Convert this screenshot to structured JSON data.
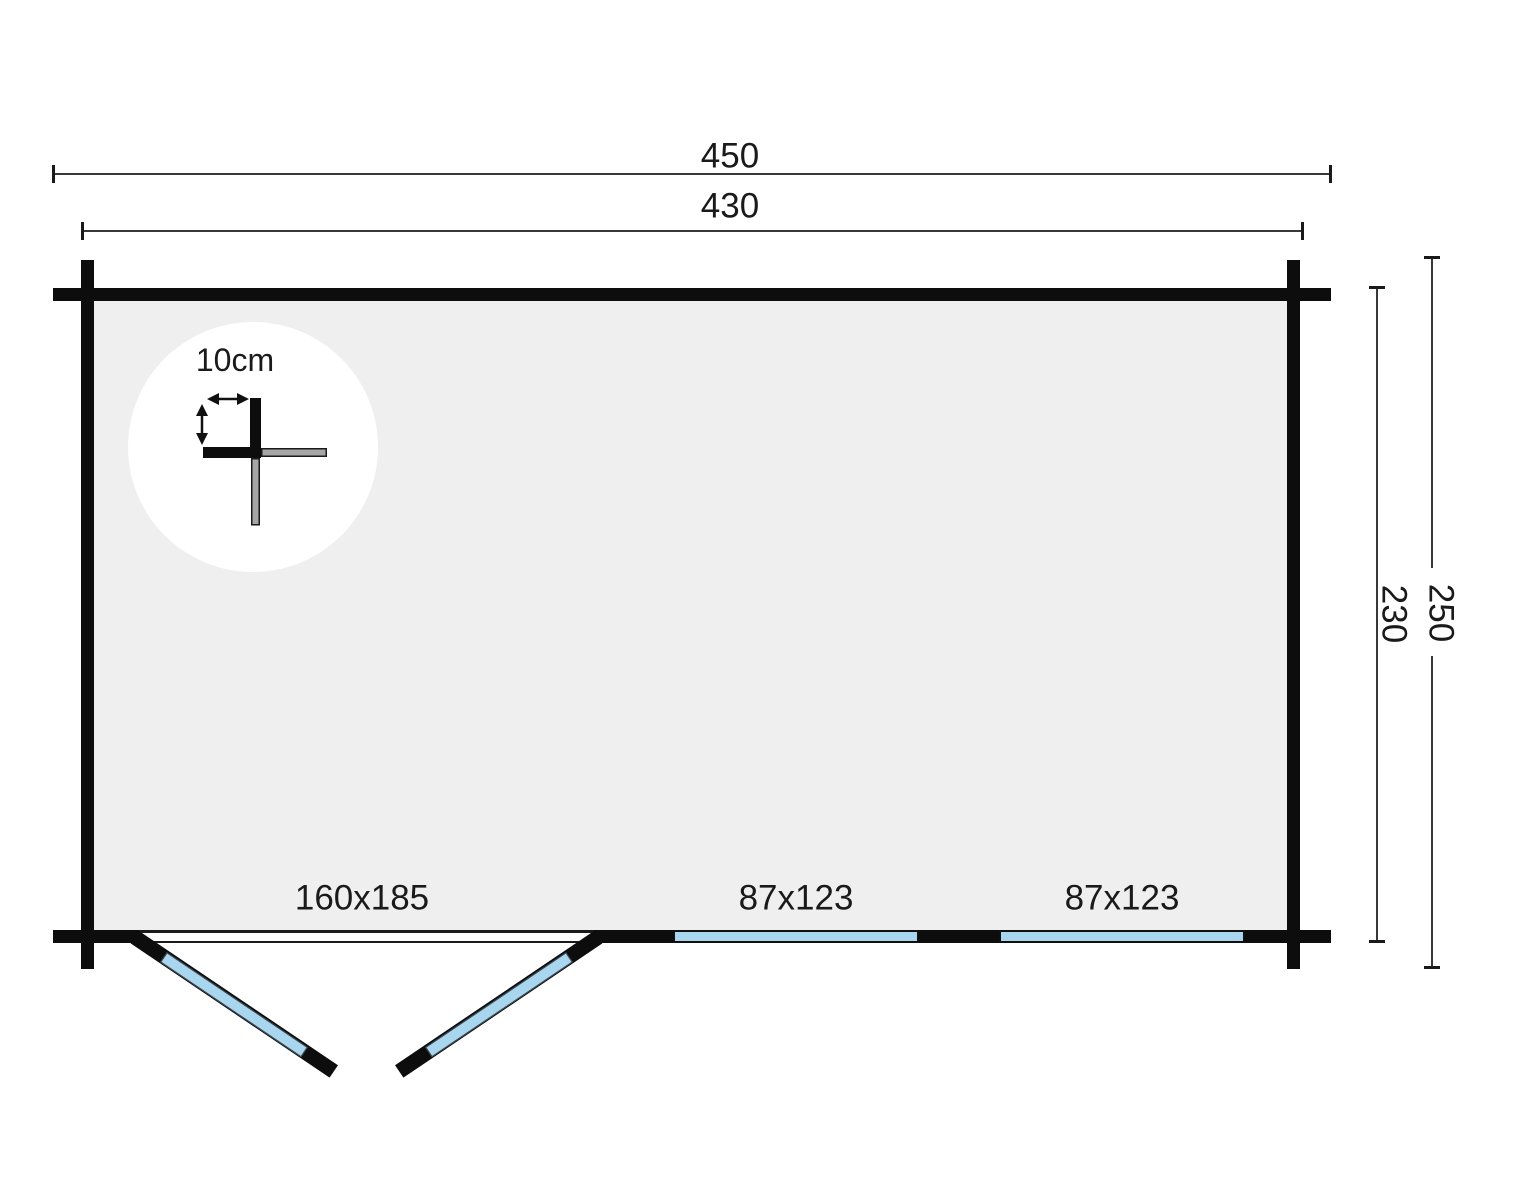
{
  "dimensions": {
    "outer_width": "450",
    "inner_width": "430",
    "outer_depth": "250",
    "inner_depth": "230"
  },
  "corner_detail": {
    "label": "10cm"
  },
  "openings": {
    "door": {
      "label": "160x185"
    },
    "window_left": {
      "label": "87x123"
    },
    "window_right": {
      "label": "87x123"
    }
  },
  "colors": {
    "wall": "#0d0d0d",
    "glass": "#a8d6ef",
    "floor": "#efefef",
    "dim": "#383838",
    "text": "#1a1a1a",
    "log_gray": "#a6a6a6",
    "detail_bg": "#ffffff"
  }
}
